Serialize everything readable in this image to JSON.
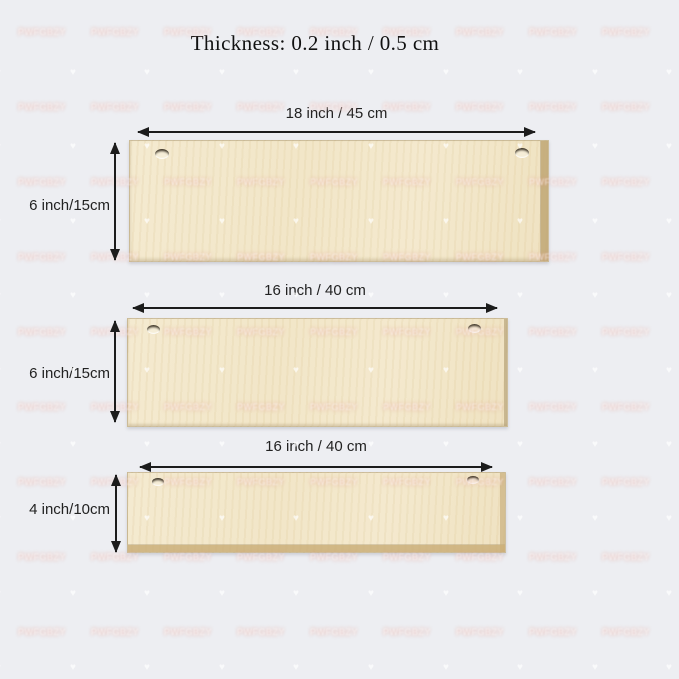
{
  "title": "Thickness: 0.2 inch / 0.5 cm",
  "boards": [
    {
      "id": "18x6",
      "width_label": "18 inch / 45 cm",
      "height_label": "6 inch/15cm"
    },
    {
      "id": "16x6",
      "width_label": "16 inch / 40 cm",
      "height_label": "6 inch/15cm"
    },
    {
      "id": "16x4",
      "width_label": "16 inch / 40 cm",
      "height_label": "4 inch/10cm"
    }
  ],
  "watermark": {
    "text": "PWFGBZY",
    "heart_icon": "♥"
  },
  "colors": {
    "background": "#edeef2",
    "board_face": "#f1e4c4",
    "board_edge": "#c9b386",
    "arrow": "#1c1c1c",
    "label_text": "#222222",
    "title_text": "#111111",
    "watermark_pink": "#e8b7ad"
  }
}
